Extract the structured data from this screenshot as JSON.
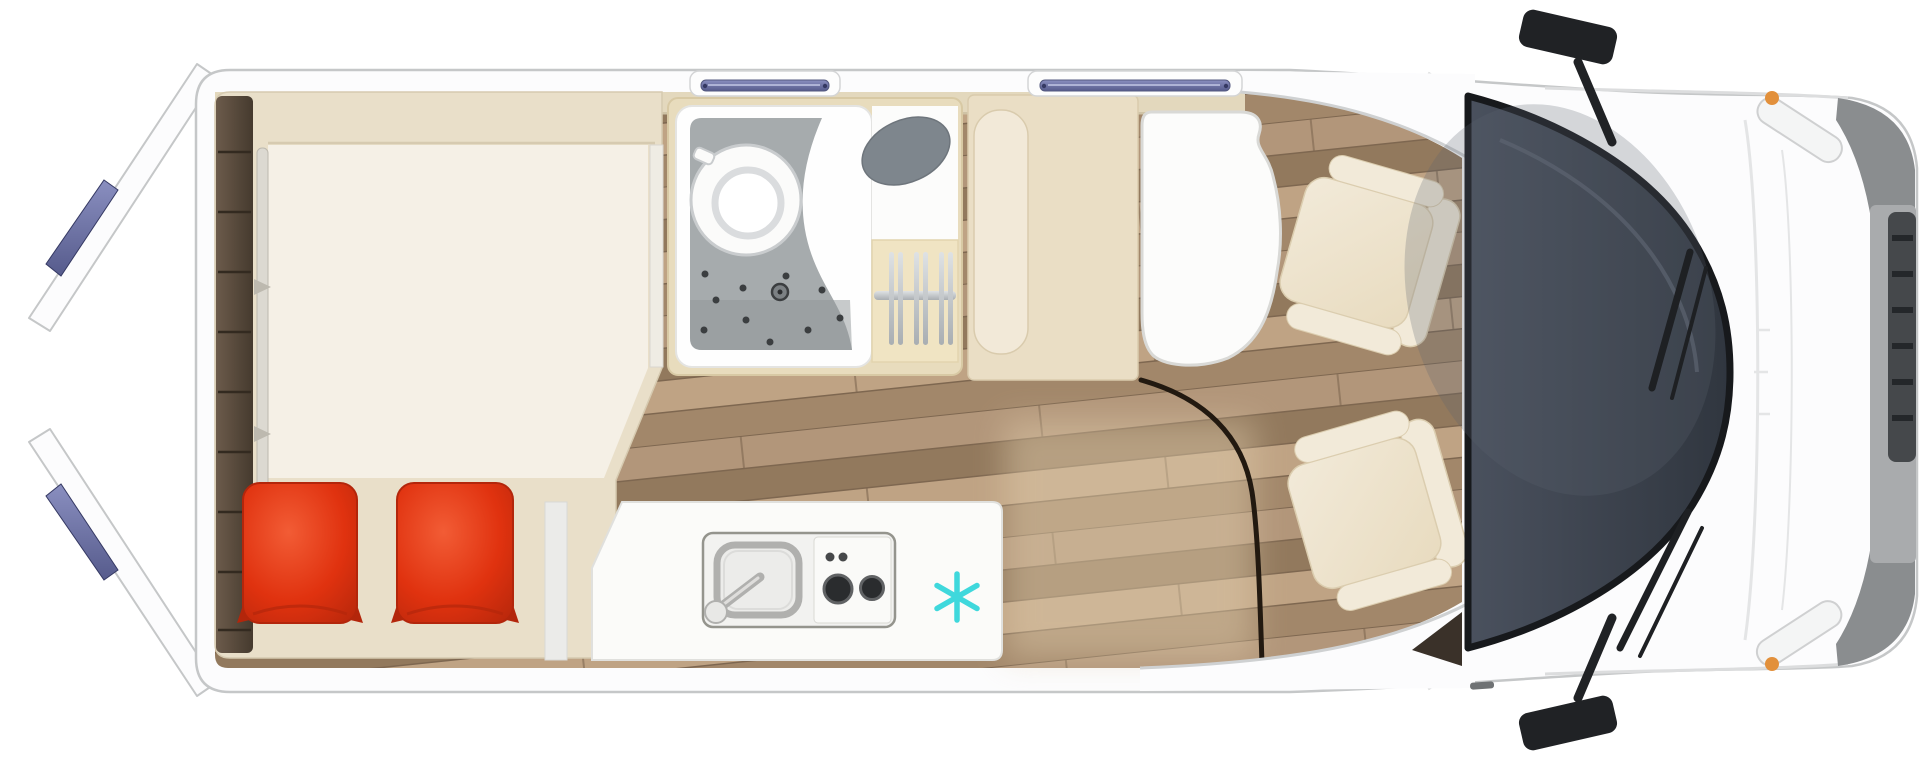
{
  "canvas": {
    "width": 1920,
    "height": 760,
    "background": "#ffffff",
    "viewBox": "0 0 1920 760"
  },
  "subject": {
    "kind": "campervan-floorplan",
    "view": "top-down-cutaway",
    "front": "right",
    "rear": "left"
  },
  "icons": {
    "freezer": {
      "name": "snowflake-freezer-icon",
      "glyph": "✳"
    }
  },
  "colors": {
    "bg": "#ffffff",
    "body": "#fcfcfd",
    "outline": "#c5c7c8",
    "band_line": "#dcddde",
    "wall": "#e3d8bd",
    "wall_edge": "#cfc3a6",
    "wood1": "#b2967a",
    "wood2": "#a2876a",
    "wood3": "#92795d",
    "wood4": "#bfa384",
    "wood_seam": "#7e6750",
    "wood_light": "#e2cfae",
    "shelf1": "#6c5b4b",
    "shelf2": "#453a2e",
    "shelf_line": "#332a20",
    "platform": "#e9dfc9",
    "platform_edge": "#d6cab0",
    "mattress": "#f5f0e6",
    "rail": "#dcd9d1",
    "rail_edge": "#bdb9af",
    "pillow": "#e0320f",
    "pillow_dark": "#b3260b",
    "pillow_light": "#f25c35",
    "bath_frame": "#e8dcbd",
    "bath_frame_edge": "#d8c9a4",
    "shower_white": "#fefefe",
    "shower_floor": "#a6abad",
    "shower_floor_dark": "#8f9598",
    "drain": "#3b3e40",
    "toilet_ring": "#c9ccce",
    "basin": "#7e868d",
    "wardrobe": "#f0e4c3",
    "metal": "#a9aeb2",
    "metal_light": "#dfe2e4",
    "counter": "#fbfbf9",
    "counter_edge": "#e0e0dd",
    "unit": "#f2f2f0",
    "unit_edge": "#94948d",
    "sink_metal": "#b0b0ae",
    "burner": "#2a2c2e",
    "burner_ring": "#606264",
    "knob": "#46484a",
    "snowflake": "#3fd8dc",
    "bench": "#eadec5",
    "bench_edge": "#d9cbad",
    "cushion": "#f2e9d8",
    "table": "#fcfcfb",
    "table_edge": "#d9d9d6",
    "arc": "#221910",
    "seat": "#e8dbbf",
    "seat_light": "#f2ead9",
    "seat_edge": "#dbcdaf",
    "glass1": "#4a515e",
    "glass2": "#30363f",
    "glass_edge": "#17191c",
    "wiper": "#1e2023",
    "mirror": "#202225",
    "window_blue1": "#8a8fc0",
    "window_blue2": "#565b8c",
    "window_frame": "#fdfdfd",
    "window_dot": "#353963",
    "bumper": "#a9abad",
    "bumper_dark": "#8a8d8f",
    "grille": "#45484b",
    "grille_slat": "#24272a",
    "hood_line": "#e4e5e6",
    "accent_orange": "#e2903b",
    "dark_wedge": "#3a3129"
  }
}
